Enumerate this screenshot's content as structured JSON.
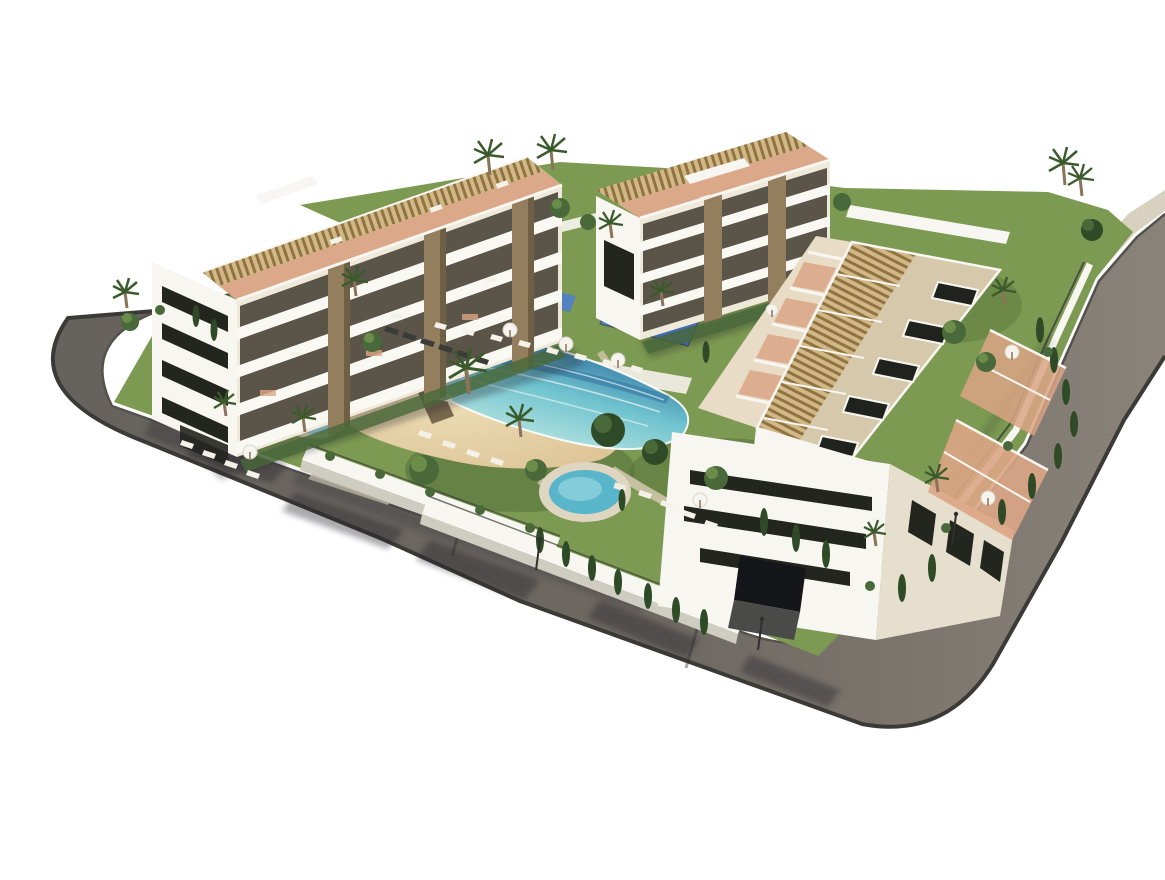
{
  "meta": {
    "type": "3d-architectural-render",
    "subject": "Aerial 3D render of a modern residential apartment complex with communal lagoon pool, gardens and perimeter road",
    "background": "#ffffff"
  },
  "palette": {
    "bg": "#ffffff",
    "asphalt1": "#66625d",
    "asphalt2": "#8a837a",
    "sidewalk": "#d9d1c0",
    "curb": "#3c3a36",
    "shadow": "#20242b",
    "wallWhite": "#f8f6f1",
    "wallShade": "#cfccc2",
    "facadeCream": "#efe9da",
    "slabWhite": "#faf8f3",
    "windowDark": "#23251f",
    "glassBrown": "#3f3a2f",
    "stone": "#937f5e",
    "pergolaTan": "#d2b787",
    "pergolaBrown": "#8f7442",
    "terracotta": "#dba585",
    "roofBeige": "#d6c9ab",
    "hatchDark": "#20221e",
    "deckLight": "#efece1",
    "lawn": "#7c9a52",
    "lawnDark": "#55703a",
    "lawnLight": "#93ad66",
    "sand": "#e1cb9f",
    "sandLight": "#ecdcb4",
    "poolDeep": "#2e6f9e",
    "poolMid": "#6fc3cf",
    "poolLight": "#c9ebe4",
    "spaWater": "#59b5c9",
    "coping": "#ded6c1",
    "kidney": "#9cdce1",
    "playBlue": "#4d7ed2",
    "playBlueLight": "#7fa3e4",
    "treeDark": "#2f4a27",
    "treeMid": "#49693a",
    "treeLight": "#6b8d4a",
    "palmGreen": "#3b5b2d",
    "trunk": "#8a7356",
    "loungerWhite": "#f4f1e8",
    "loungerDark": "#3a3d37",
    "umbWhite": "#f6f4ee",
    "fence": "#3a3f38"
  },
  "scene": {
    "road": {
      "label": "perimeter-road",
      "surfaces": [
        "dark-asphalt",
        "beige-sidewalk"
      ],
      "features": [
        "rounded-corners",
        "tree-shadows",
        "parking-bay",
        "street-lamps"
      ]
    },
    "buildings": [
      {
        "id": "block-left",
        "floors_visible": 4,
        "features": [
          "white-facade",
          "dark-ribbon-windows",
          "stone-clad-pillars",
          "wide-balconies",
          "rooftop-pergolas",
          "rooftop-terraces",
          "garage-entrance"
        ]
      },
      {
        "id": "block-center",
        "floors_visible": 4,
        "features": [
          "white-facade",
          "stone-clad-pillars",
          "balconies",
          "rooftop-pergolas",
          "rooftop-canopy-frame"
        ]
      },
      {
        "id": "block-right",
        "floors_visible": 4,
        "features": [
          "long-roof-with-hatches",
          "rooftop-pergola-row",
          "stepped-garden-terraces",
          "street-facade-ribbon-windows",
          "garage-entrance",
          "east-terraces-with-parasols"
        ]
      }
    ],
    "amenities": [
      {
        "id": "lagoon-pool",
        "style": "beach-entry",
        "water": "turquoise-to-deep-blue"
      },
      {
        "id": "spa-round-pool"
      },
      {
        "id": "kidney-pool"
      },
      {
        "id": "playground-blue-court"
      },
      {
        "id": "sun-deck-with-loungers"
      },
      {
        "id": "sand-beach-area"
      }
    ],
    "vegetation": [
      "palm-trees",
      "cypress-trees",
      "round-canopy-trees",
      "lawns",
      "hedges"
    ]
  }
}
